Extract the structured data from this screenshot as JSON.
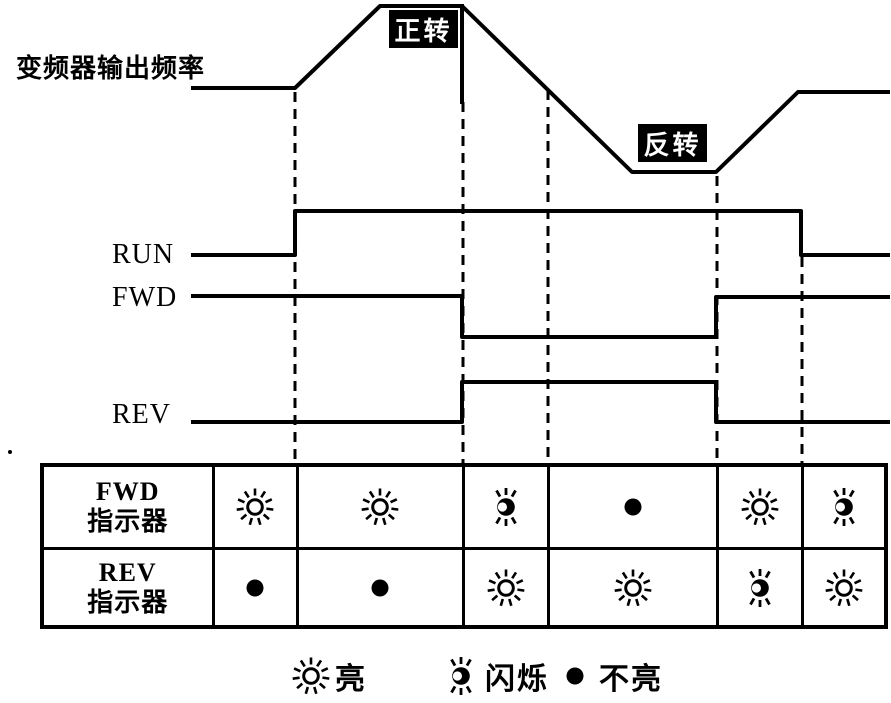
{
  "colors": {
    "ink": "#000000",
    "paper": "#ffffff"
  },
  "freq_axis_label": "变频器输出频率",
  "rotation_tags": [
    {
      "text": "正转"
    },
    {
      "text": "反转"
    }
  ],
  "signal_labels": {
    "run": "RUN",
    "fwd": "FWD",
    "rev": "REV"
  },
  "indicator_table": {
    "row_headers": [
      [
        "FWD",
        "指示器"
      ],
      [
        "REV",
        "指示器"
      ]
    ],
    "columns": 6,
    "states": {
      "fwd_row": [
        "on",
        "on",
        "flash",
        "off",
        "on",
        "flash"
      ],
      "rev_row": [
        "off",
        "off",
        "on",
        "on",
        "flash",
        "on"
      ]
    }
  },
  "legend": [
    {
      "state": "on",
      "label": "亮"
    },
    {
      "state": "flash",
      "label": "闪烁"
    },
    {
      "state": "off",
      "label": "不亮"
    }
  ],
  "timing": {
    "frequency": [
      [
        193,
        88
      ],
      [
        295,
        88
      ],
      [
        380,
        6
      ],
      [
        462,
        6
      ],
      [
        632,
        172
      ],
      [
        716,
        172
      ],
      [
        798,
        92
      ],
      [
        888,
        92
      ]
    ],
    "direction_divider": [
      [
        462,
        6
      ],
      [
        462,
        102
      ]
    ],
    "run": [
      [
        193,
        255
      ],
      [
        295,
        255
      ],
      [
        295,
        211
      ],
      [
        801,
        211
      ],
      [
        801,
        255
      ],
      [
        888,
        255
      ]
    ],
    "fwd": [
      [
        193,
        296
      ],
      [
        462,
        296
      ],
      [
        462,
        337
      ],
      [
        716,
        337
      ],
      [
        716,
        297
      ],
      [
        888,
        297
      ]
    ],
    "rev": [
      [
        193,
        422
      ],
      [
        462,
        422
      ],
      [
        462,
        382
      ],
      [
        716,
        382
      ],
      [
        716,
        422
      ],
      [
        888,
        422
      ]
    ],
    "guides": [
      {
        "x": 295,
        "y1": 92,
        "y2": 463
      },
      {
        "x": 463,
        "y1": 102,
        "y2": 463
      },
      {
        "x": 548,
        "y1": 90,
        "y2": 463
      },
      {
        "x": 717,
        "y1": 176,
        "y2": 463
      },
      {
        "x": 802,
        "y1": 257,
        "y2": 463
      }
    ]
  }
}
